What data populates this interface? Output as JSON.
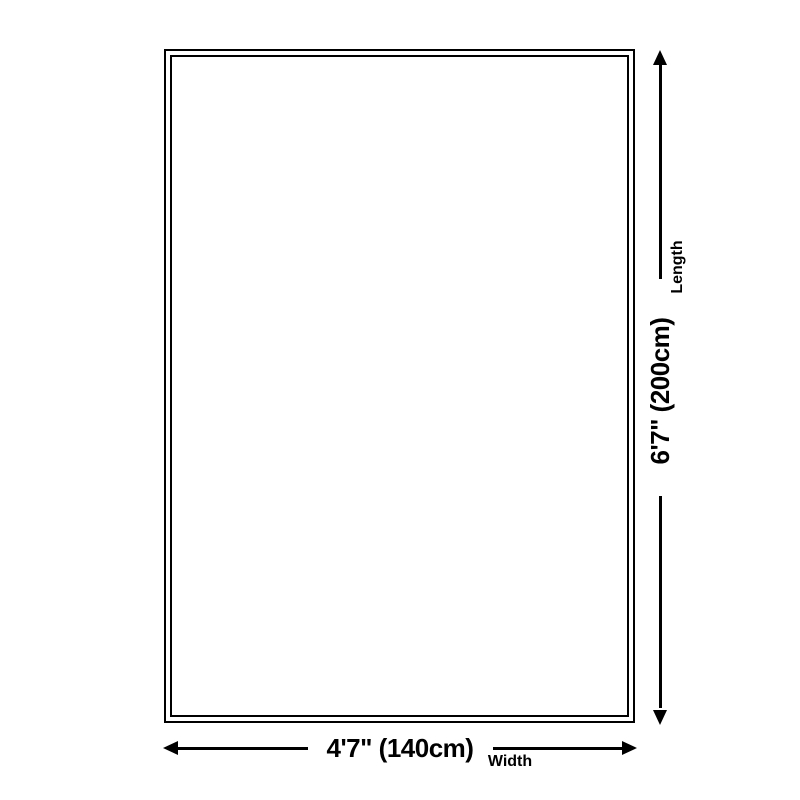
{
  "colors": {
    "background": "#ffffff",
    "line": "#000000",
    "text": "#000000"
  },
  "diagram": {
    "type": "product-dimension-diagram",
    "shape": "rectangle-double-border"
  },
  "length_dimension": {
    "value": "6'7\" (200cm)",
    "label": "Length",
    "orientation": "vertical"
  },
  "width_dimension": {
    "value": "4'7\" (140cm)",
    "label": "Width",
    "orientation": "horizontal"
  }
}
